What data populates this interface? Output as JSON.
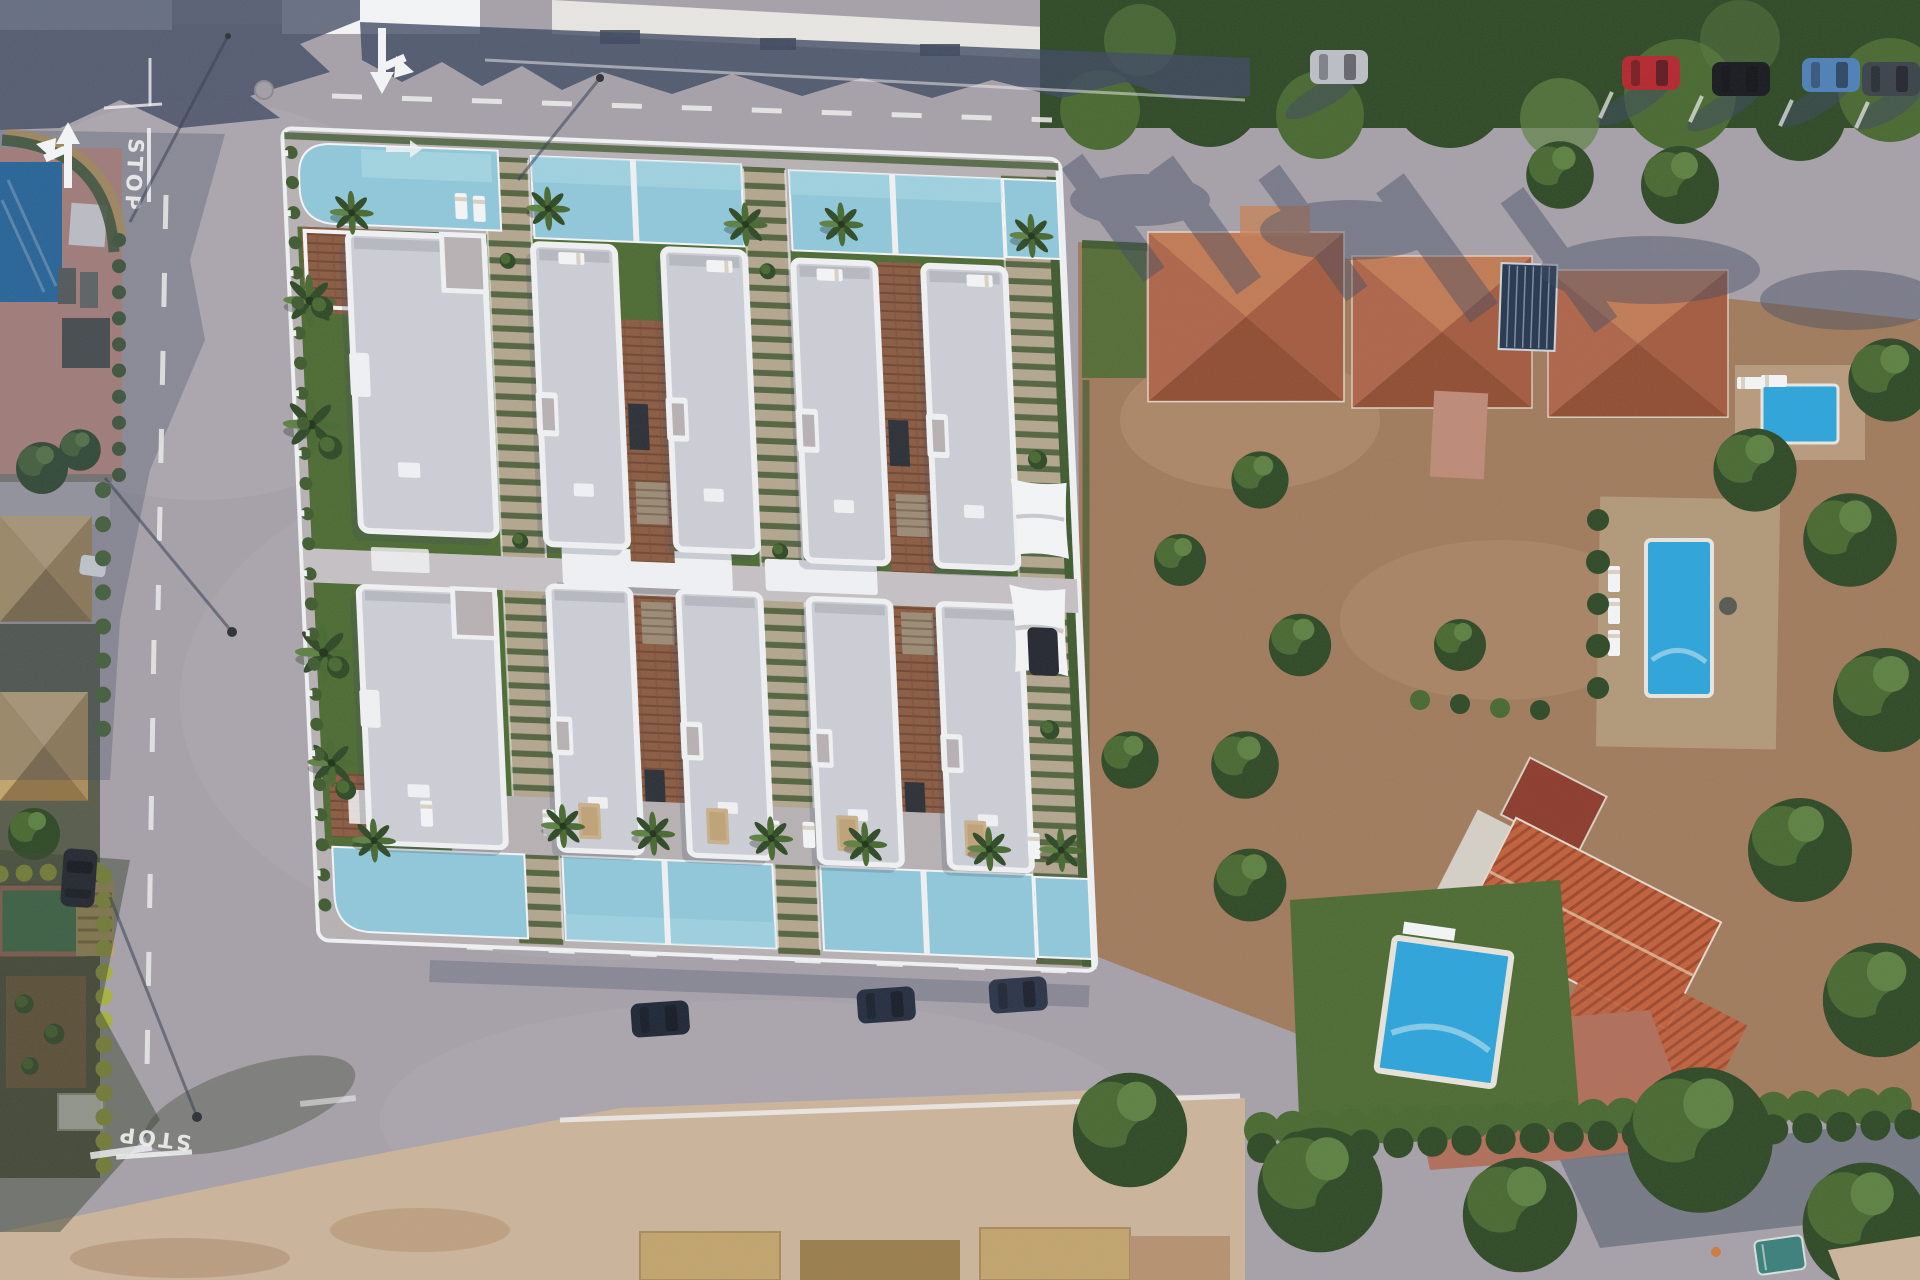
{
  "scene": {
    "description": "Aerial drone view of a new-build white villa development with private pools, surrounded by roads and existing terracotta-roof houses",
    "labels": {
      "stop": "STOP"
    }
  },
  "palette": {
    "asphalt": "#a6a0a8",
    "asphalt_light": "#b6b0b6",
    "shadow_blue": "#3d4860",
    "tree_dark": "#2d4824",
    "tree_mid": "#47682f",
    "tree_light": "#5d8040",
    "terracotta": "#ad6448",
    "terracotta_light": "#c68256",
    "terracotta_dark": "#8f4c31",
    "roof_white": "#f1f2f4",
    "roof_gray": "#ccced6",
    "concrete": "#b7b1b3",
    "concrete_light": "#c6c1c3",
    "grass": "#4c6a31",
    "grass_light": "#5f8038",
    "hedge": "#3f5a2e",
    "terrace_tan": "#b3a68e",
    "terrace_green": "#53633e",
    "deck_brown": "#8a5a40",
    "deck_dark": "#6e4630",
    "pool_dev": "#8fc8da",
    "pool_dev_light": "#a9d8e4",
    "pool_vivid": "#2ba4da",
    "pool_navy": "#1e6fae",
    "salmon": "#c99184",
    "sand": "#cbb49a",
    "dirt": "#a07a5b",
    "dirt_light": "#b59270",
    "yellow_hedge": "#a8b13e",
    "court_green": "#3e7a55",
    "court_pink": "#bb6e66",
    "white": "#f5f6f7",
    "tan_roof": "#c2a46b",
    "tan_roof_dark": "#9a7d4c",
    "marking_white": "#f2f2f0",
    "car_red": "#b3262c",
    "car_black": "#16181d",
    "car_blue": "#4d7fb5",
    "car_silver": "#bcbfc5",
    "car_gray": "#3a4148",
    "car_navy": "#1d2534",
    "car_teal": "#3a7f7a"
  },
  "development": {
    "white_villas": 10,
    "private_pools": 12,
    "shade_sails": 2,
    "palm_trees": 16
  },
  "surroundings": {
    "neighbor_pools": 4,
    "parked_cars_top_road": 5,
    "parked_cars_bottom_road": 3,
    "stop_markings": 2
  }
}
